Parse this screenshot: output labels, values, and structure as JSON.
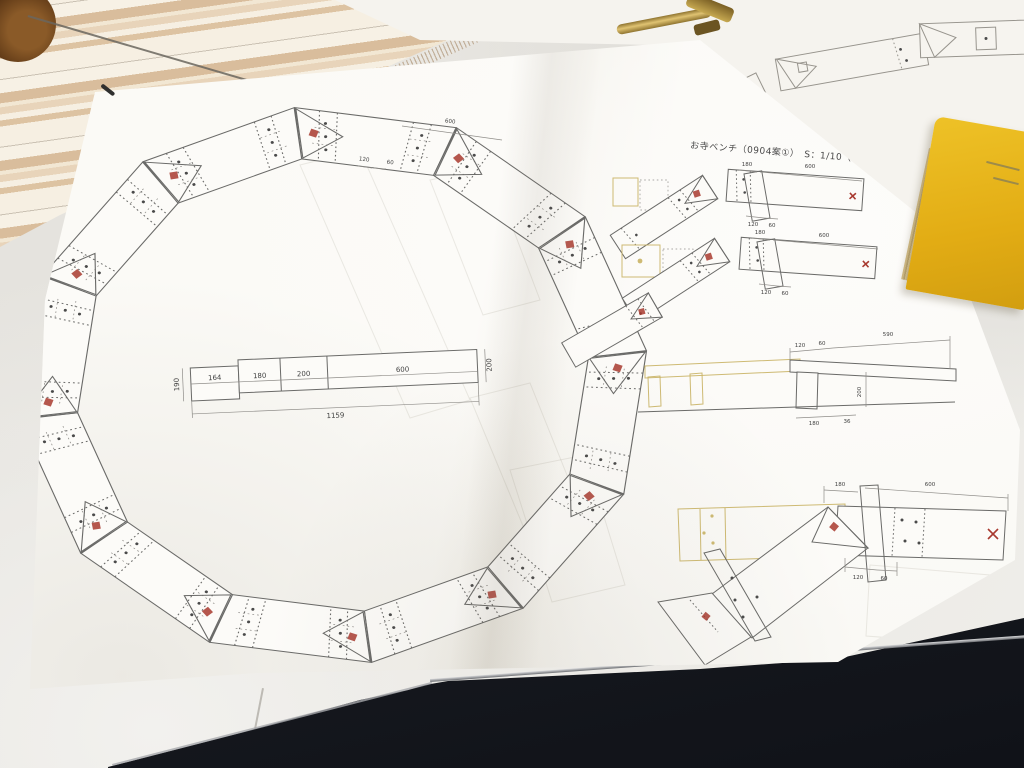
{
  "photo": {
    "sheet_title": "お寺ベンチ（0904案①）　S：1/10（A3）",
    "ring": {
      "plank_length": "600",
      "joint_a": "120",
      "joint_b": "60"
    },
    "bench_elevation": {
      "seg1": "164",
      "seg2": "180",
      "seg3": "200",
      "seg4": "600",
      "total": "1159",
      "height_left": "190",
      "height_right": "200"
    },
    "joint_detail_top": {
      "offset": "180",
      "length": "600",
      "a": "120",
      "b": "60"
    },
    "joint_detail_mid": {
      "offset": "180",
      "length": "600",
      "a": "120",
      "b": "60"
    },
    "side_section": {
      "a": "120",
      "b": "60",
      "length": "590",
      "c": "180",
      "d": "36",
      "height": "200"
    },
    "joint_plan": {
      "offset": "180",
      "length": "600",
      "a": "120",
      "b": "60"
    },
    "colors": {
      "red_mark": "#a8392f",
      "ghost_yellow": "#c9b264",
      "paper": "#fbfaf6",
      "tablet": "#181b21",
      "notebook_yellow": "#e2ac14"
    }
  }
}
